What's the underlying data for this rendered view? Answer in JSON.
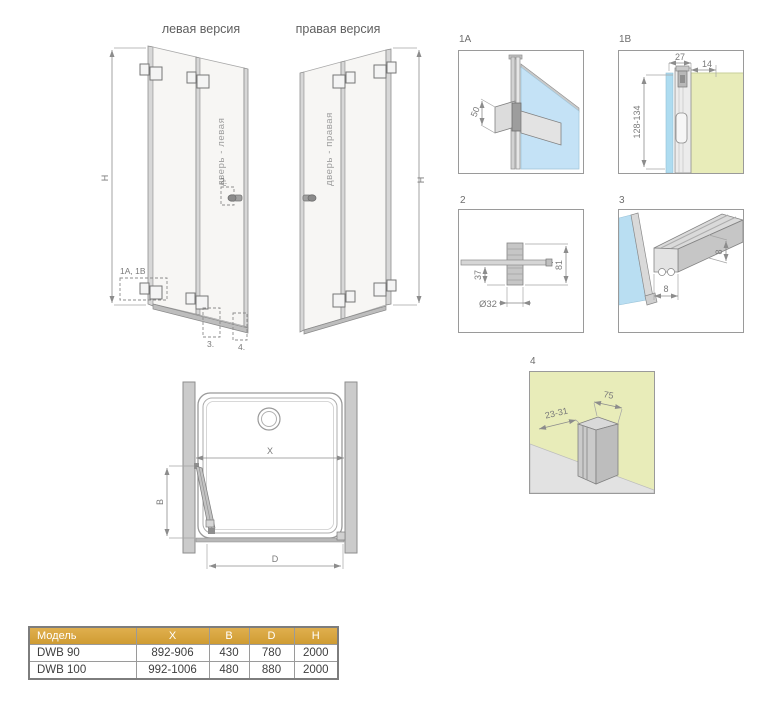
{
  "titles": {
    "left_version": "левая версия",
    "right_version": "правая версия"
  },
  "doors": {
    "left": {
      "label": "дверь - левая",
      "height_dim": "H",
      "callout_hinge": "1A, 1B",
      "callout_handle": "2.",
      "callout_threshold": "3.",
      "callout_wall_profile": "4."
    },
    "right": {
      "label": "дверь - правая",
      "height_dim": "H"
    }
  },
  "details": {
    "d1a": {
      "id": "1A",
      "dim_hinge_width": "50"
    },
    "d1b": {
      "id": "1B",
      "dim_depth": "27",
      "dim_offset": "14",
      "dim_height_range": "128-134"
    },
    "d2": {
      "id": "2",
      "dim_inset": "37",
      "dim_height": "81",
      "dim_diameter": "Ø32"
    },
    "d3": {
      "id": "3",
      "dim_width": "8",
      "dim_height": "8"
    },
    "d4": {
      "id": "4",
      "dim_range": "23-31",
      "dim_width": "75"
    }
  },
  "plan": {
    "dim_x": "X",
    "dim_b": "B",
    "dim_d": "D"
  },
  "table": {
    "headers": [
      "Модель",
      "X",
      "B",
      "D",
      "H"
    ],
    "rows": [
      [
        "DWB 90",
        "892-906",
        "430",
        "780",
        "2000"
      ],
      [
        "DWB 100",
        "992-1006",
        "480",
        "880",
        "2000"
      ]
    ]
  },
  "colors": {
    "table_header_gold": "#d7a53d",
    "glass_blue": "#aedcf0",
    "wall_yellow": "#e8ecb9",
    "line_gray": "#8c8c8c"
  }
}
